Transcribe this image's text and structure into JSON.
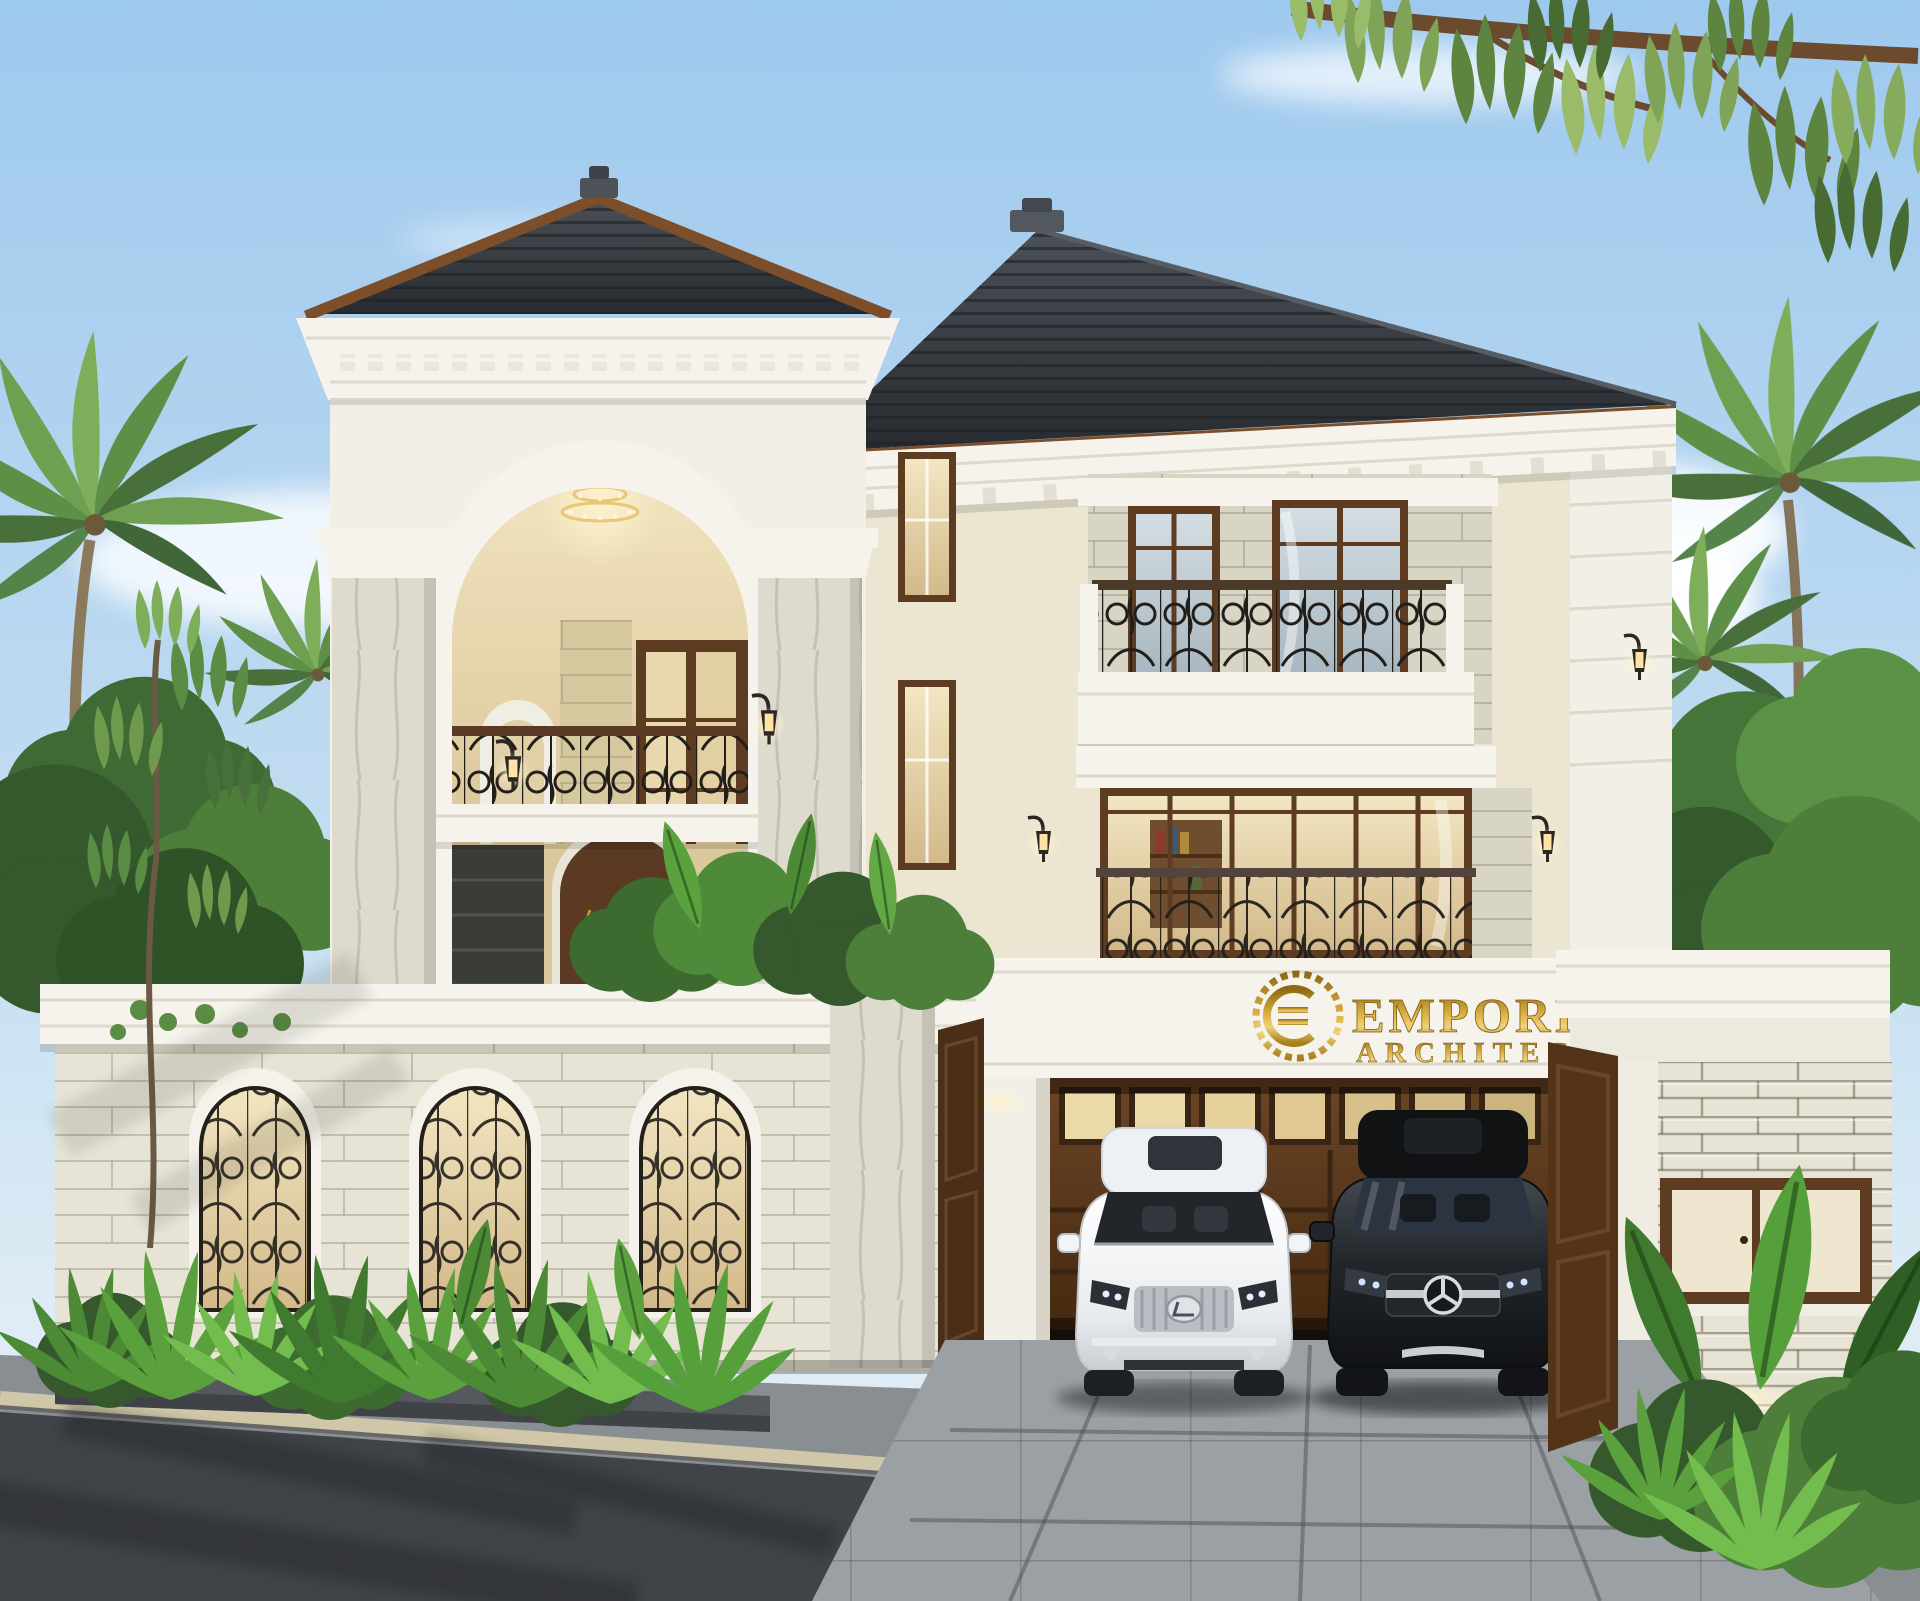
{
  "scene": {
    "type": "architectural-exterior-render",
    "description": "Daytime 3D render of a luxury three-storey classical villa: dark hip roofs with wood fascia, white cornices, cream walls with light stone cladding, wrought-iron balconies, arched entry with chandelier, front fence with three arched iron-grill windows, tropical palms and plants, carport with two SUVs, asphalt road in front",
    "sign": {
      "brand": "EMPORIO",
      "subtitle": "ARCHITECT",
      "logo": "laurel-wreath-monogram"
    },
    "vehicles": [
      {
        "label": "white SUV",
        "badge": "lexus-badge"
      },
      {
        "label": "black SUV",
        "badge": "mercedes-star"
      }
    ],
    "colors": {
      "sky_top": "#9ec9ee",
      "sky_low": "#dcebf5",
      "cloud": "#ffffff",
      "roof": "#31363c",
      "roof_line": "#1d2126",
      "fascia": "#7c4e2a",
      "cornice": "#f5f3ec",
      "wall": "#f2efe6",
      "wall_cream": "#ece5d2",
      "stone": "#d9d5c5",
      "stone_fence": "#e8e4d5",
      "marble": "#dedacd",
      "wood": "#5d3c22",
      "wood_dark": "#4a2e17",
      "glass_warm": "#ecdcb4",
      "glass_cool": "#c3d0d8",
      "glass_dark": "#23272c",
      "iron": "#221f1a",
      "gold": "#c59a2f",
      "gold_deep": "#8f6a14",
      "leaf_dark": "#30522b",
      "leaf": "#4e7f3a",
      "leaf_light": "#79ab4e",
      "driveway": "#9ba0a5",
      "sidewalk": "#898e93",
      "curb": "#cfc7a7",
      "road": "#404449"
    }
  }
}
